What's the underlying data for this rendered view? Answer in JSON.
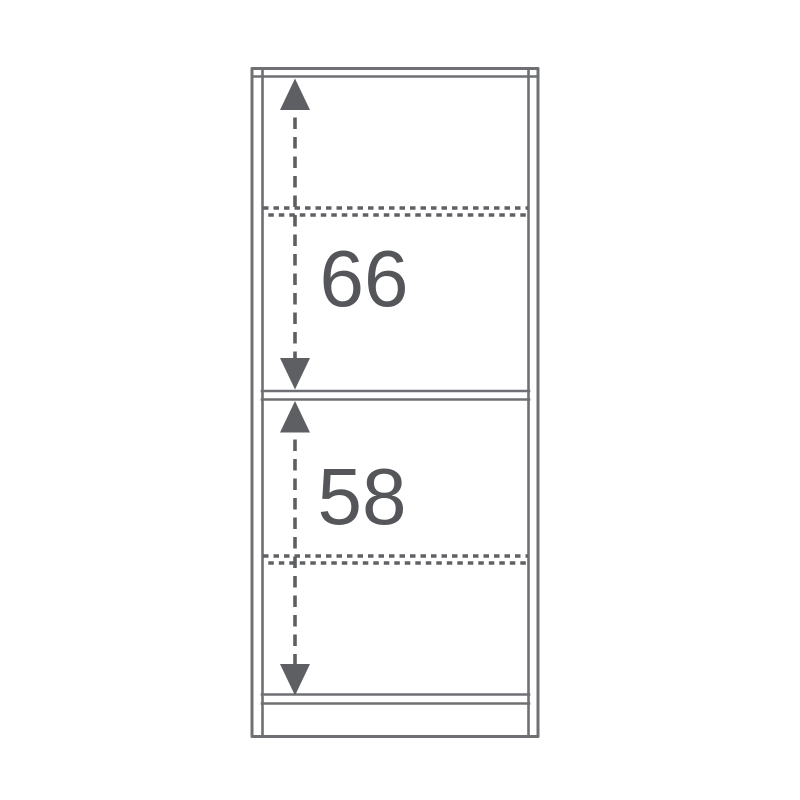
{
  "diagram": {
    "kind": "furniture dimension drawing",
    "subject": "bookcase front view with interior section heights",
    "background_color": "#ffffff",
    "colors": {
      "outline": "#6e7073",
      "dimension": "#5d5f62",
      "label_text": "#54565a"
    },
    "dimensions": [
      {
        "id": "upper-section-height",
        "label": "66"
      },
      {
        "id": "lower-section-height",
        "label": "58"
      }
    ],
    "visible_parts": [
      "top panel (double line)",
      "left side panel (double line)",
      "right side panel (double line)",
      "upper adjustable shelf (dotted line)",
      "fixed middle shelf (double line)",
      "lower adjustable shelf (dotted line)",
      "bottom panel (double line)",
      "plinth base"
    ]
  }
}
